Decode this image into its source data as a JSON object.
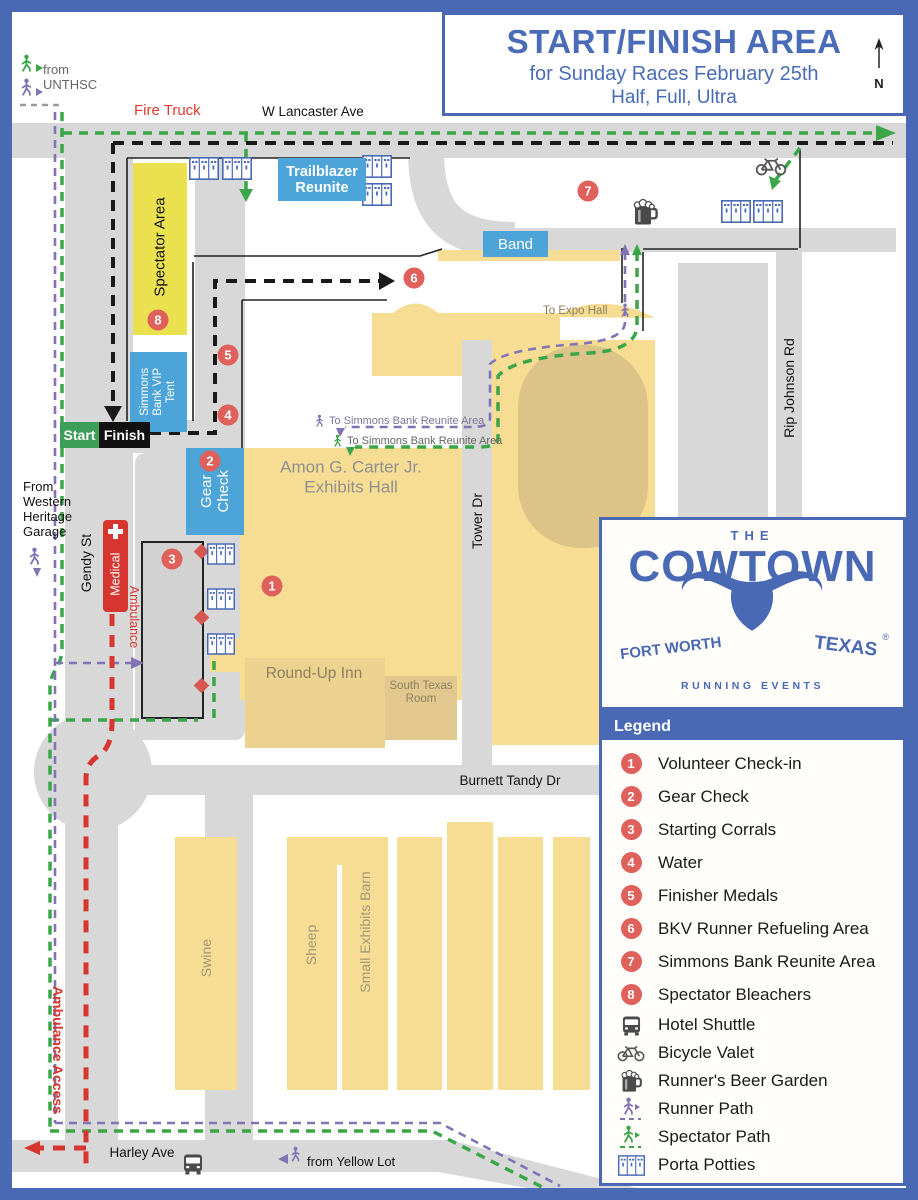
{
  "title": {
    "line1": "START/FINISH AREA",
    "line2": "for Sunday Races February 25th",
    "line3": "Half, Full, Ultra",
    "compass_n": "N"
  },
  "streets": {
    "lancaster": "W Lancaster Ave",
    "gendy": "Gendy St",
    "tower": "Tower Dr",
    "rip_johnson": "Rip Johnson Rd",
    "burnett": "Burnett Tandy Dr",
    "harley": "Harley Ave"
  },
  "routes": {
    "fire_truck": "Fire Truck",
    "from_unthsc": "from\nUNTHSC",
    "from_western_heritage": "From\nWestern\nHeritage\nGarage",
    "ambulance_access": "Ambulance Access",
    "from_yellow_lot": "from Yellow Lot",
    "to_expo_hall": "To Expo Hall",
    "to_simmons_runner": "To Simmons Bank  Reunite Area",
    "to_simmons_spectator": "To Simmons Bank Reunite Area"
  },
  "zones": {
    "spectator_area": "Spectator Area",
    "trailblazer_reunite": "Trailblazer\nReunite",
    "band": "Band",
    "simmons_vip": "Simmons\nBank VIP\nTent",
    "start": "Start",
    "finish": "Finish",
    "gear_check": "Gear\nCheck",
    "medical": "Medical",
    "ambulance": "Ambulance"
  },
  "buildings": {
    "amon": "Amon G. Carter Jr.\nExhibits Hall",
    "roundup": "Round-Up Inn",
    "south_texas": "South Texas\nRoom",
    "swine": "Swine",
    "sheep": "Sheep",
    "small_exhibits": "Small Exhibits Barn"
  },
  "legend": {
    "header": "Legend",
    "items": [
      {
        "num": "1",
        "icon": "marker",
        "label": "Volunteer Check-in"
      },
      {
        "num": "2",
        "icon": "marker",
        "label": "Gear Check"
      },
      {
        "num": "3",
        "icon": "marker",
        "label": "Starting Corrals"
      },
      {
        "num": "4",
        "icon": "marker",
        "label": "Water"
      },
      {
        "num": "5",
        "icon": "marker",
        "label": "Finisher Medals"
      },
      {
        "num": "6",
        "icon": "marker",
        "label": "BKV Runner Refueling Area"
      },
      {
        "num": "7",
        "icon": "marker",
        "label": "Simmons Bank Reunite Area"
      },
      {
        "num": "8",
        "icon": "marker",
        "label": "Spectator Bleachers"
      },
      {
        "icon": "bus",
        "label": "Hotel Shuttle"
      },
      {
        "icon": "bike",
        "label": "Bicycle Valet"
      },
      {
        "icon": "beer",
        "label": "Runner's Beer Garden"
      },
      {
        "icon": "runner-path",
        "label": "Runner Path"
      },
      {
        "icon": "spectator-path",
        "label": "Spectator Path"
      },
      {
        "icon": "porta",
        "label": "Porta Potties"
      }
    ]
  },
  "logo": {
    "the": "THE",
    "name": "COWTOWN",
    "city": "FORT WORTH",
    "state": "TEXAS",
    "tagline": "RUNNING EVENTS",
    "reg": "®"
  },
  "colors": {
    "frame_blue": "#4a69b4",
    "title_blue": "#4a6cb8",
    "road_gray": "#d8d8d8",
    "building_yellow": "#f7dd94",
    "dome_tan": "#dcc489",
    "spectator_yellow": "#ebe14e",
    "zone_blue": "#4da4d9",
    "marker_red": "#e0605c",
    "alert_red": "#d6362f",
    "start_green": "#3d9e59",
    "spectator_path_green": "#3aa648",
    "runner_path_purple": "#8273b4"
  }
}
